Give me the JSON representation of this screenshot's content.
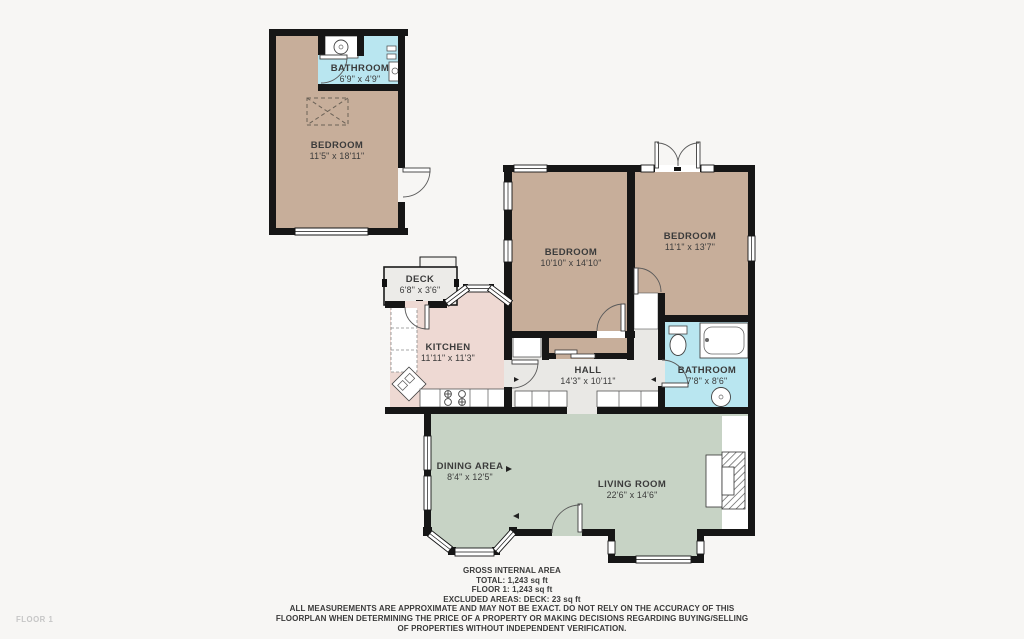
{
  "floorplan": {
    "floor_label": "FLOOR 1",
    "rooms": [
      {
        "id": "bathroom-top",
        "name": "BATHROOM",
        "dims": "6'9\" x 4'9\""
      },
      {
        "id": "bedroom-top",
        "name": "BEDROOM",
        "dims": "11'5\" x 18'11\""
      },
      {
        "id": "bedroom-left",
        "name": "BEDROOM",
        "dims": "10'10\" x 14'10\""
      },
      {
        "id": "bedroom-right",
        "name": "BEDROOM",
        "dims": "11'1\" x 13'7\""
      },
      {
        "id": "deck",
        "name": "DECK",
        "dims": "6'8\" x 3'6\""
      },
      {
        "id": "kitchen",
        "name": "KITCHEN",
        "dims": "11'11\" x 11'3\""
      },
      {
        "id": "hall",
        "name": "HALL",
        "dims": "14'3\" x 10'11\""
      },
      {
        "id": "bathroom-main",
        "name": "BATHROOM",
        "dims": "7'8\" x 8'6\""
      },
      {
        "id": "dining",
        "name": "DINING AREA",
        "dims": "8'4\" x 12'5\""
      },
      {
        "id": "living",
        "name": "LIVING ROOM",
        "dims": "22'6\" x 14'6\""
      }
    ],
    "footer": {
      "title": "GROSS INTERNAL AREA",
      "total": "TOTAL: 1,243 sq ft",
      "floor1": "FLOOR 1: 1,243 sq ft",
      "excluded": "EXCLUDED AREAS: DECK: 23 sq ft",
      "disclaimer1": "ALL MEASUREMENTS ARE APPROXIMATE AND MAY NOT BE EXACT. DO NOT RELY ON THE ACCURACY OF THIS",
      "disclaimer2": "FLOORPLAN WHEN DETERMINING THE PRICE OF A PROPERTY OR MAKING DECISIONS REGARDING BUYING/SELLING",
      "disclaimer3": "OF PROPERTIES WITHOUT INDEPENDENT VERIFICATION."
    },
    "colors": {
      "bedroom_tan": "#c7ae9a",
      "kitchen_pink": "#eed9d3",
      "living_green": "#c7d3c5",
      "bathroom_blue": "#b9e6f0",
      "hall_gray": "#e9e8e5",
      "deck_gray": "#ecebe8",
      "wall_black": "#161616",
      "background": "#f7f6f4"
    }
  }
}
